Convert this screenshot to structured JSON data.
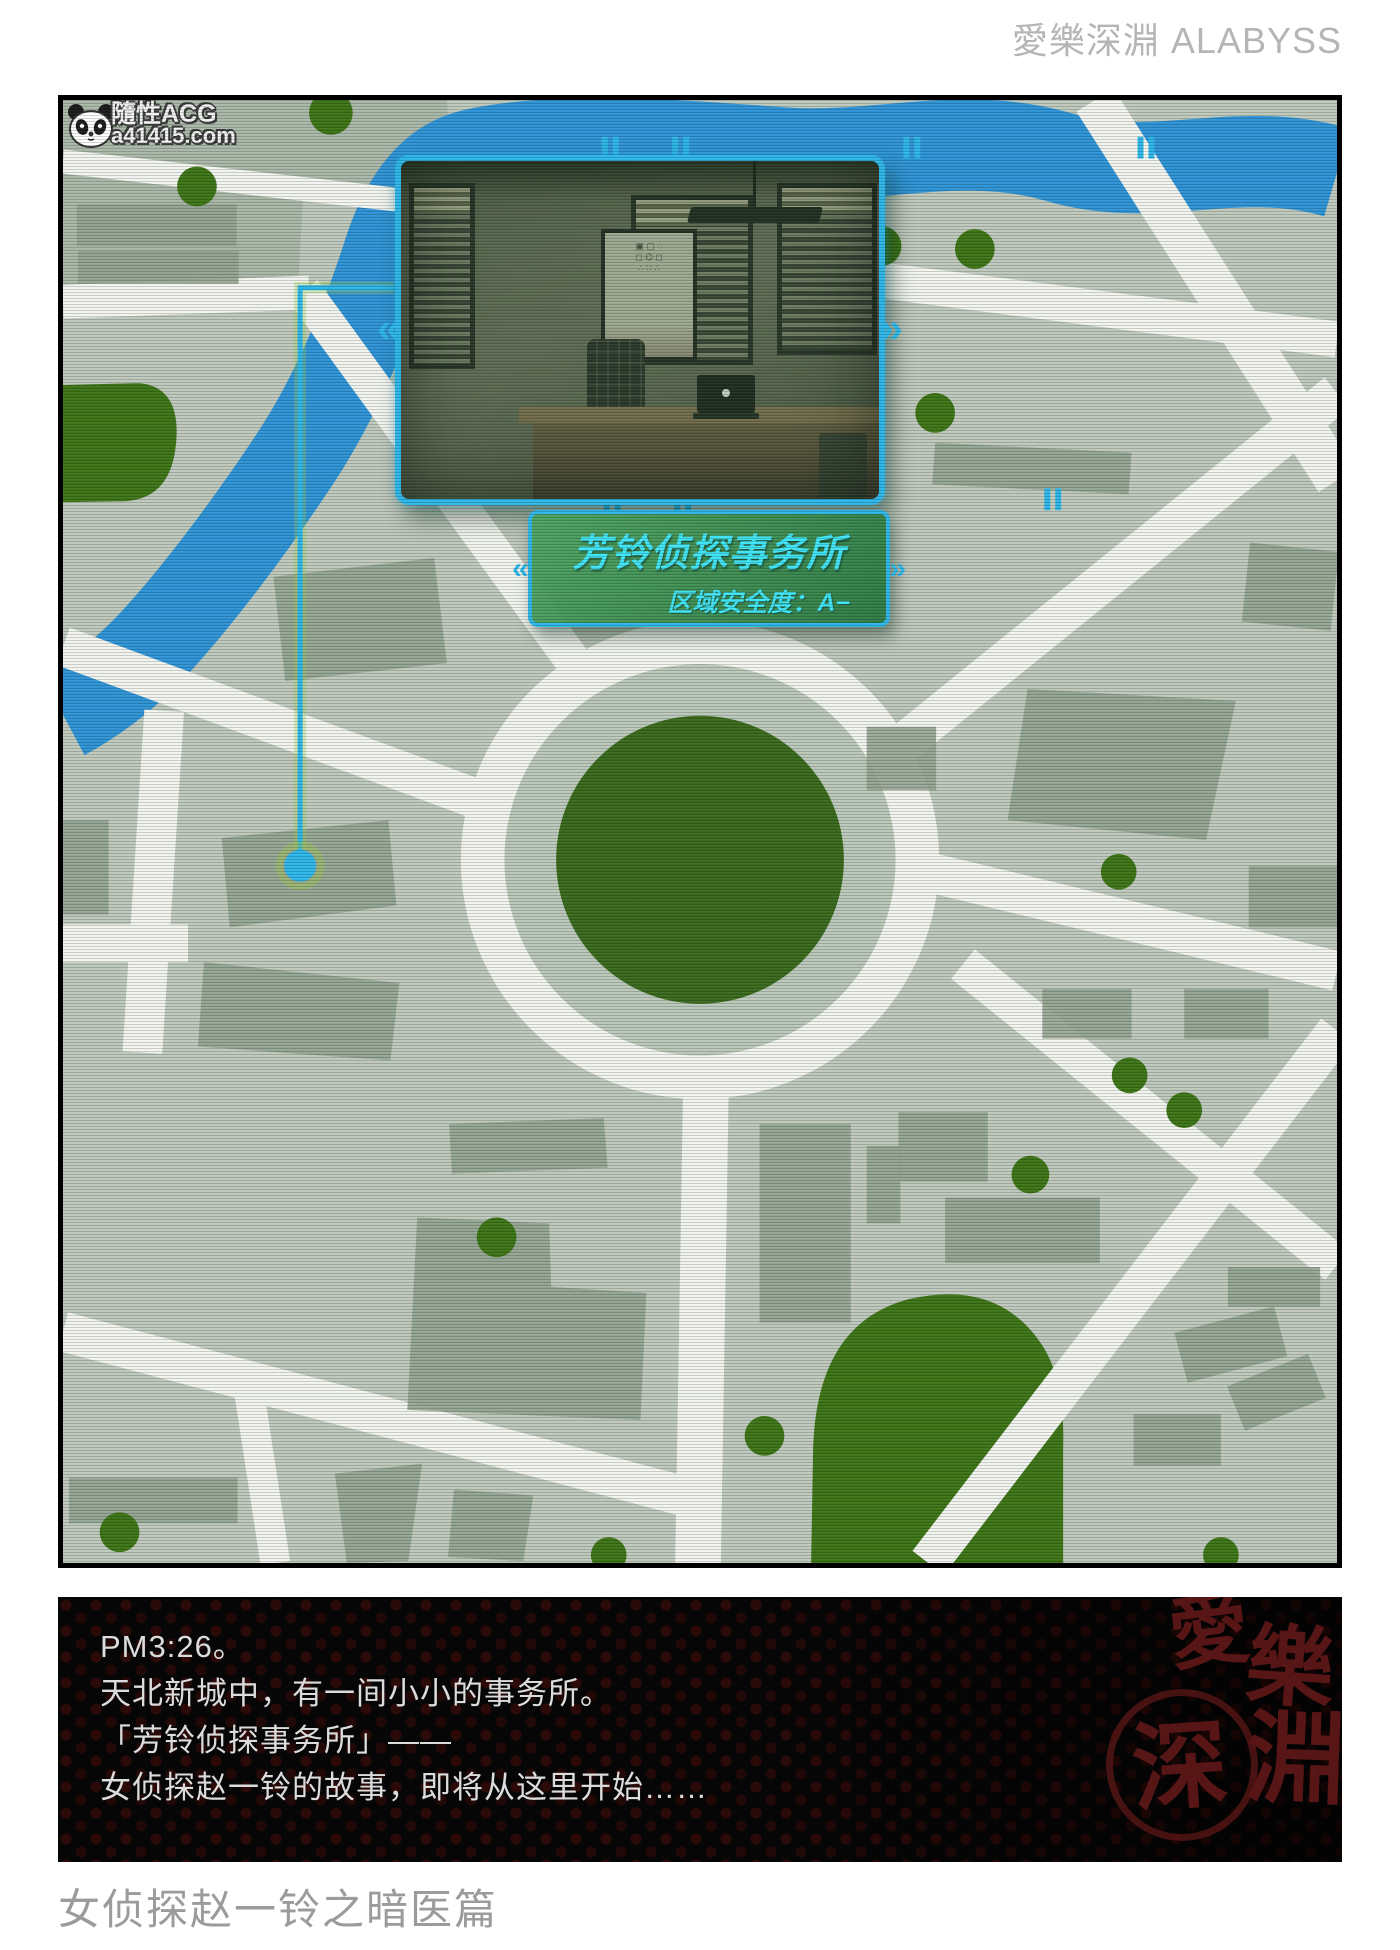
{
  "header": {
    "brand": "愛樂深淵 ALABYSS"
  },
  "watermark": {
    "icon": "panda-icon",
    "title": "隨性ACG",
    "url": "a41415.com"
  },
  "map": {
    "hud": {
      "location_title": "芳铃侦探事务所",
      "security_label": "区域安全度：",
      "security_value": "A−",
      "left_chevron": "«",
      "right_chevron": "»"
    }
  },
  "dialogue": {
    "lines": [
      "PM3:26。",
      "天北新城中，有一间小小的事务所。",
      "「芳铃侦探事务所」——",
      "女侦探赵一铃的故事，即将从这里开始……"
    ]
  },
  "seal": {
    "chars": [
      "愛",
      "樂",
      "深",
      "淵"
    ]
  },
  "caption": "女侦探赵一铃之暗医篇",
  "colors": {
    "map-base": "#bfc8bc",
    "district": "#a9b7a8",
    "building": "#8f9f8d",
    "road": "#f2f4ef",
    "water": "#2e93d6",
    "park": "#3d7416",
    "roundabout": "#39691c",
    "hud-cyan": "#2cb6e9",
    "hud-text": "#3fe3f6",
    "seal-red": "#5c1717"
  }
}
